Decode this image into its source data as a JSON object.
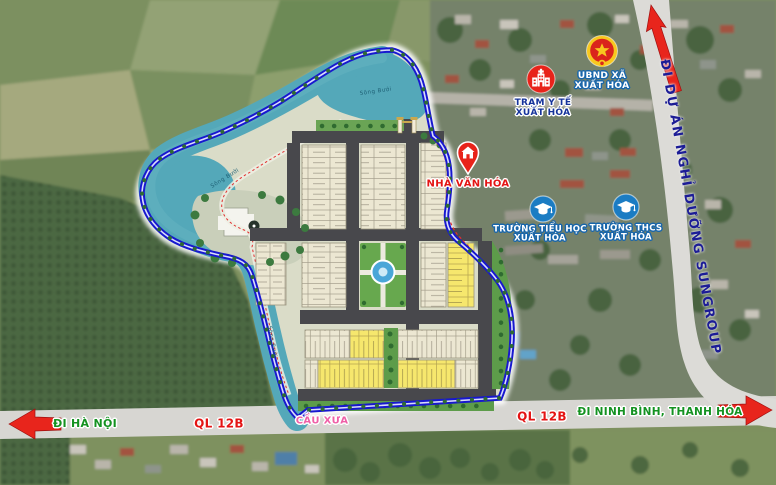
{
  "map": {
    "road_labels": {
      "di_ha_noi": "ĐI HÀ NỘI",
      "ql12b_left": "QL 12B",
      "cau_xua": "CẦU XƯA",
      "ql12b_right": "QL 12B",
      "di_ninh_binh": "ĐI NINH BÌNH, THANH HÓA",
      "sungroup": "ĐI DỰ ÁN NGHỈ DƯỠNG SUNGROUP"
    },
    "river_label": "Sông Bưởi",
    "pois": [
      {
        "id": "tram-y-te",
        "icon": "hospital-icon",
        "line1": "TRẠM Y TẾ",
        "line2": "XUẤT HÓA"
      },
      {
        "id": "ubnd-xa",
        "icon": "emblem-icon",
        "line1": "UBND XÃ",
        "line2": "XUẤT HÓA"
      },
      {
        "id": "nha-van-hoa",
        "icon": "house-pin-icon",
        "line1": "NHÀ VĂN HÓA"
      },
      {
        "id": "truong-tieu-hoc",
        "icon": "school-icon",
        "line1": "TRƯỜNG TIỂU HỌC",
        "line2": "XUẤT HÓA"
      },
      {
        "id": "truong-thcs",
        "icon": "school-icon",
        "line1": "TRƯỜNG THCS",
        "line2": "XUẤT HÓA"
      }
    ],
    "colors": {
      "boundary_blue": "#1717cf",
      "water_teal": "#54a8b9",
      "lot_cream": "#ece7d2",
      "lot_yellow": "#f6e76d",
      "park_green": "#67a84e",
      "road_dark": "#48484c",
      "highway_gray": "#d7d6d2",
      "arrow_red": "#e8251c",
      "label_green": "#149221",
      "label_red": "#e41414",
      "label_pink": "#ef5fa7",
      "label_navy": "#1c1c96"
    }
  }
}
